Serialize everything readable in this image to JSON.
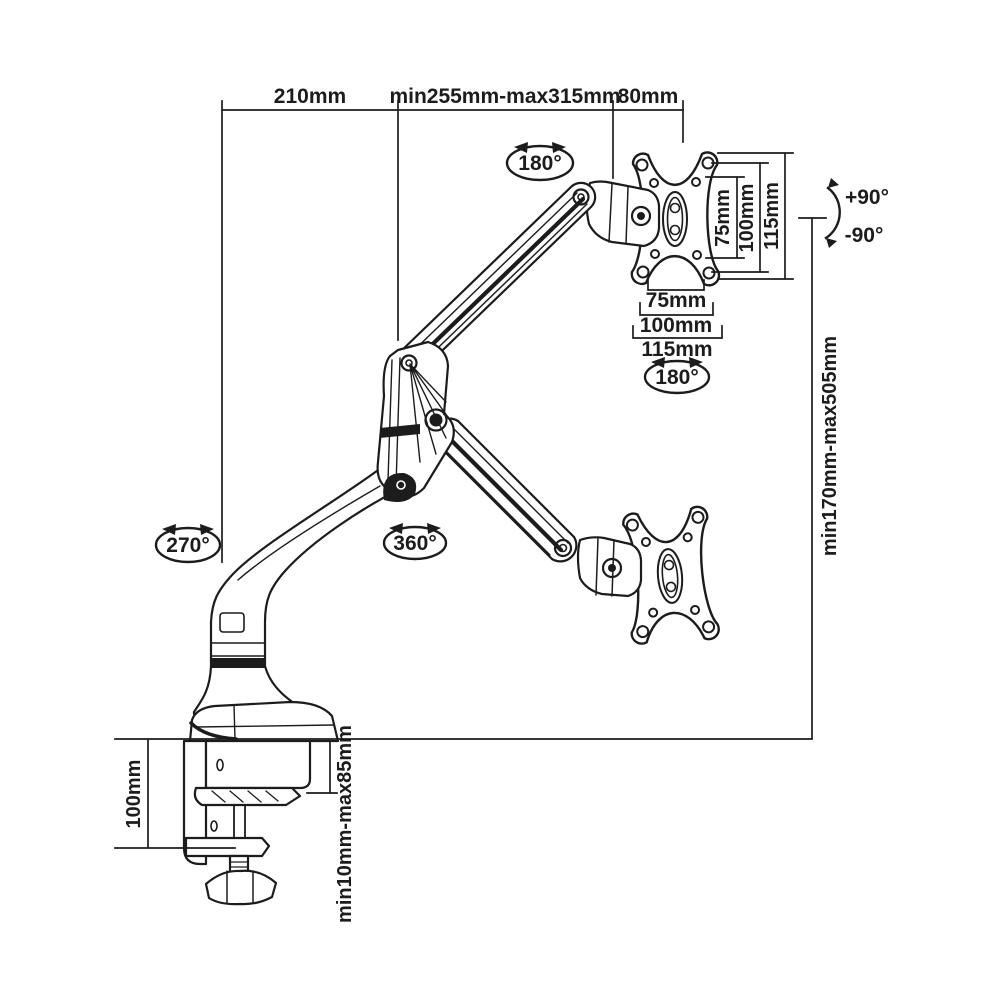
{
  "title": "Gas-spring desk monitor arm technical dimension drawing",
  "colors": {
    "line": "#1c1c1c",
    "background": "#ffffff"
  },
  "labels": {
    "top": {
      "lower_arm_reach": "210mm",
      "upper_arm_range": "min255mm-max315mm",
      "head_offset": "80mm"
    },
    "vesa_side": {
      "inner": "75mm",
      "mid": "100mm",
      "outer": "115mm"
    },
    "vesa_bottom": {
      "inner": "75mm",
      "mid": "100mm",
      "outer": "115mm"
    },
    "tilt": {
      "up": "+90°",
      "down": "-90°"
    },
    "height_range": "min170mm-max505mm",
    "clamp": {
      "bracket_height": "100mm",
      "desk_thickness_range": "min10mm-max85mm"
    },
    "rotation": {
      "top_joint": "180°",
      "vesa_plate": "180°",
      "base": "270°",
      "elbow": "360°"
    }
  }
}
